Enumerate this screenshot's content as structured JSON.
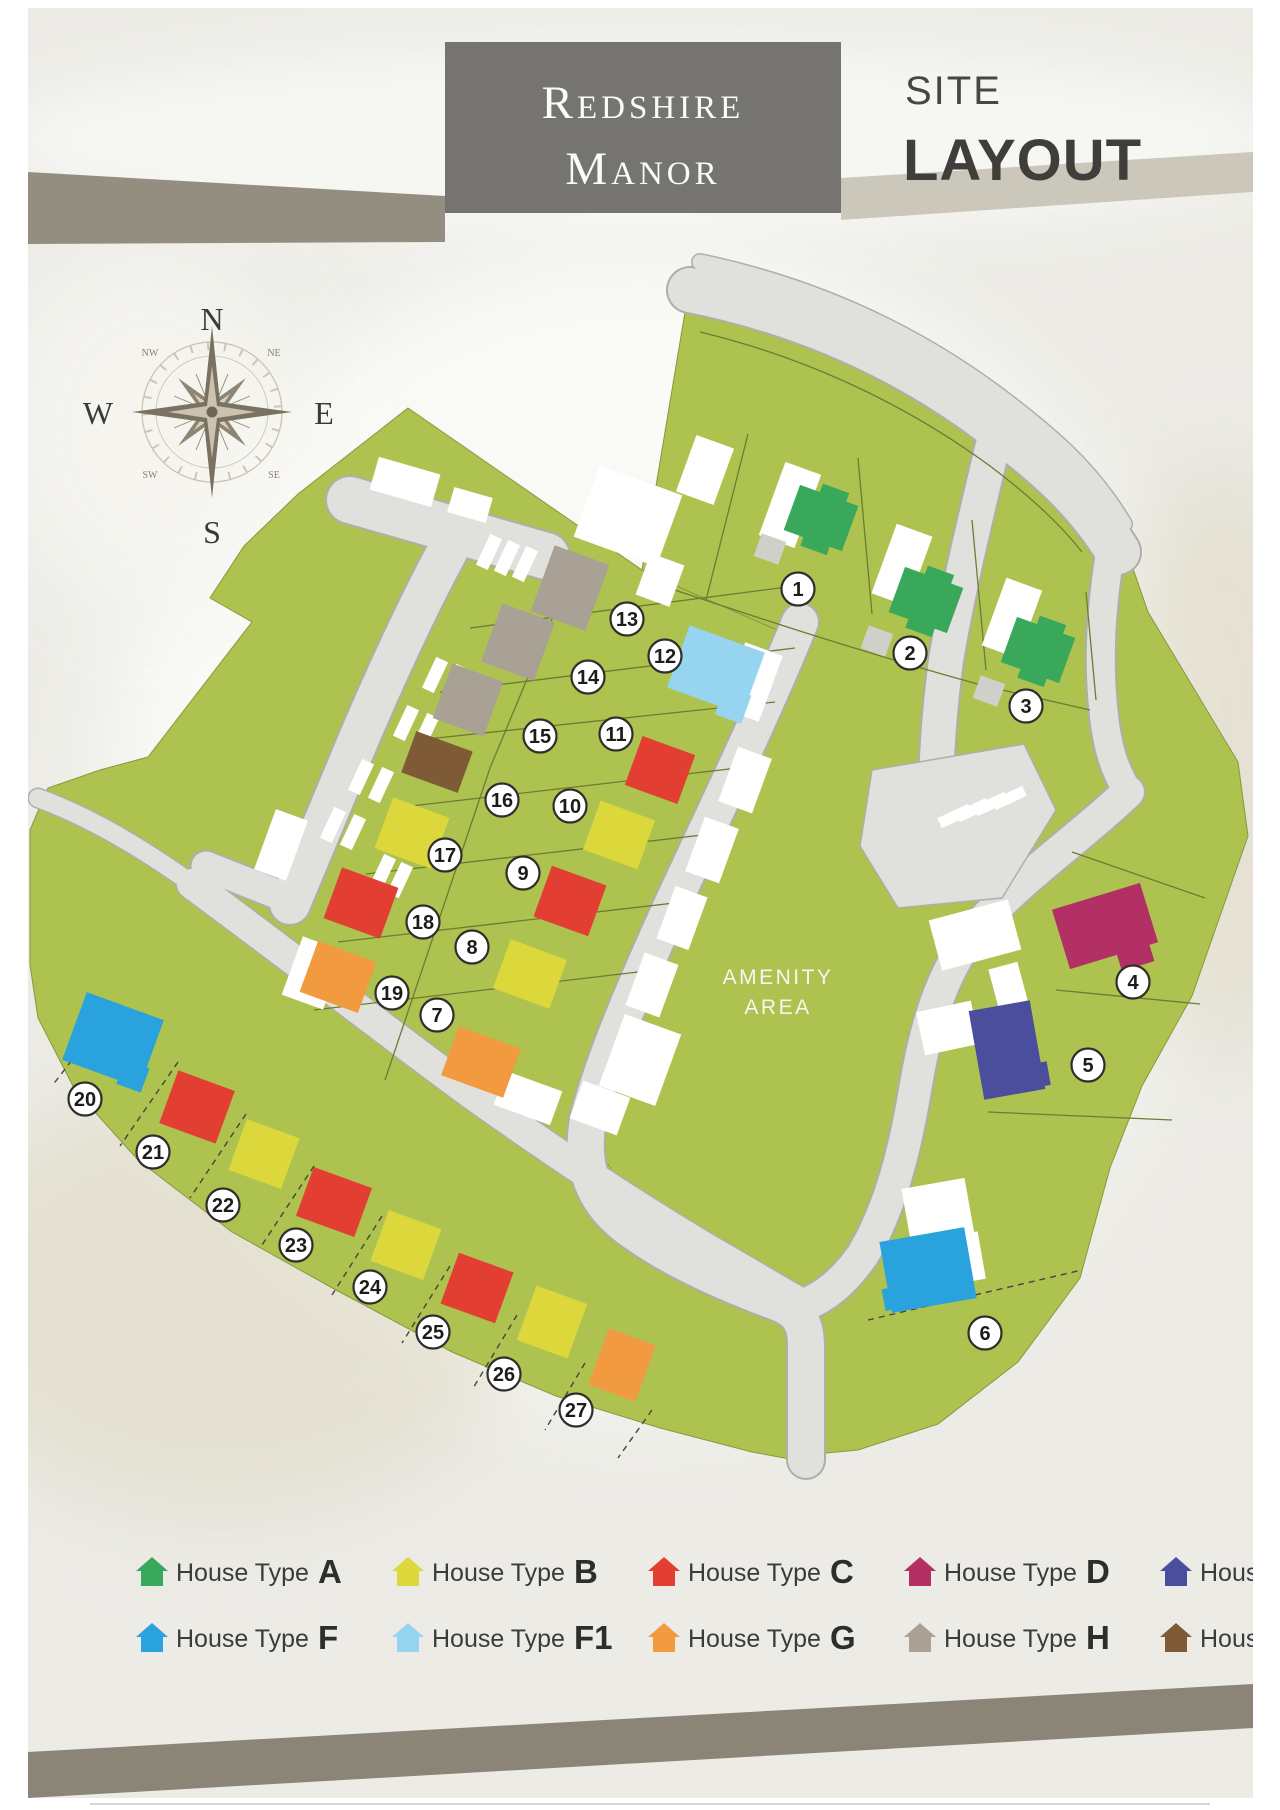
{
  "header": {
    "title_line1": "Redshire",
    "title_line2": "Manor",
    "subtitle_line1": "SITE",
    "subtitle_line2": "LAYOUT"
  },
  "compass": {
    "north": "N",
    "south": "S",
    "east": "E",
    "west": "W",
    "northwest": "NW",
    "northeast": "NE",
    "southwest": "SW",
    "southeast": "SE"
  },
  "map": {
    "amenity_label_line1": "AMENITY",
    "amenity_label_line2": "AREA",
    "colors": {
      "land": "#adc24f",
      "road": "#e0e1dd",
      "road_edge": "#aeafa8",
      "plot_white": "#ffffff",
      "garage": "#d0cfca",
      "boundary_line": "#6c7c34",
      "dashed_line": "#44453e",
      "badge_fill": "#ffffff",
      "badge_stroke": "#2e2e2c"
    },
    "plots": [
      {
        "number": "1",
        "type": "A"
      },
      {
        "number": "2",
        "type": "A"
      },
      {
        "number": "3",
        "type": "A"
      },
      {
        "number": "4",
        "type": "D"
      },
      {
        "number": "5",
        "type": "E"
      },
      {
        "number": "6",
        "type": "F"
      },
      {
        "number": "7",
        "type": "G"
      },
      {
        "number": "8",
        "type": "B"
      },
      {
        "number": "9",
        "type": "C"
      },
      {
        "number": "10",
        "type": "B"
      },
      {
        "number": "11",
        "type": "C"
      },
      {
        "number": "12",
        "type": "F1"
      },
      {
        "number": "13",
        "type": "H"
      },
      {
        "number": "14",
        "type": "H"
      },
      {
        "number": "15",
        "type": "H"
      },
      {
        "number": "16",
        "type": "J"
      },
      {
        "number": "17",
        "type": "B"
      },
      {
        "number": "18",
        "type": "C"
      },
      {
        "number": "19",
        "type": "G"
      },
      {
        "number": "20",
        "type": "F"
      },
      {
        "number": "21",
        "type": "C"
      },
      {
        "number": "22",
        "type": "B"
      },
      {
        "number": "23",
        "type": "C"
      },
      {
        "number": "24",
        "type": "B"
      },
      {
        "number": "25",
        "type": "C"
      },
      {
        "number": "26",
        "type": "B"
      },
      {
        "number": "27",
        "type": "G"
      }
    ]
  },
  "legend": {
    "item_label": "House Type"
  },
  "house_types": {
    "A": {
      "letter": "A",
      "color": "#3aa85a"
    },
    "B": {
      "letter": "B",
      "color": "#dcd83b"
    },
    "C": {
      "letter": "C",
      "color": "#e23e31"
    },
    "D": {
      "letter": "D",
      "color": "#b23063"
    },
    "E": {
      "letter": "E",
      "color": "#4b4e9c"
    },
    "F": {
      "letter": "F",
      "color": "#2aa2dd"
    },
    "F1": {
      "letter": "F1",
      "color": "#96d4f0"
    },
    "G": {
      "letter": "G",
      "color": "#f29a40"
    },
    "H": {
      "letter": "H",
      "color": "#a9a096"
    },
    "J": {
      "letter": "J",
      "color": "#7e5a36"
    }
  }
}
